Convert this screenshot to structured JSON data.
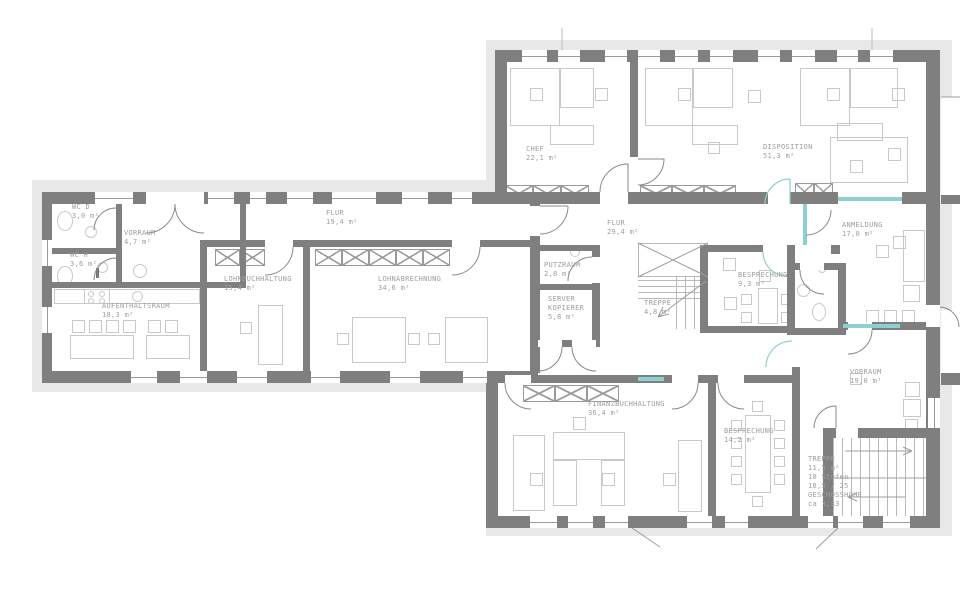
{
  "rooms": {
    "chef": {
      "name": "CHEF",
      "area": "22,1 m²"
    },
    "disposition": {
      "name": "DISPOSITION",
      "area": "51,3 m²"
    },
    "flur_rechts": {
      "name": "FLUR",
      "area": "29,4 m²"
    },
    "anmeldung": {
      "name": "ANMELDUNG",
      "area": "17,0 m²"
    },
    "wc_d": {
      "name": "WC D",
      "area": "3,0 m²"
    },
    "wc_h": {
      "name": "WC H",
      "area": "3,6 m²"
    },
    "vorraum_klein": {
      "name": "VORRAUM",
      "area": "4,7 m²"
    },
    "flur_links": {
      "name": "FLUR",
      "area": "19,4 m²"
    },
    "aufenthaltsraum": {
      "name": "AUFENTHALTSRAUM",
      "area": "18,3 m²"
    },
    "lohnbuchhaltung": {
      "name": "LOHNBUCHHALTUNG",
      "area": "15,4 m²"
    },
    "lohnabrechnung": {
      "name": "LOHNABRECHNUNG",
      "area": "34,6 m²"
    },
    "putzraum": {
      "name": "PUTZRAUM",
      "area": "2,8 m²"
    },
    "server": {
      "name": "SERVER",
      "name2": "KOPIERER",
      "area": "5,8 m²"
    },
    "treppe_mitte": {
      "name": "TREPPE",
      "area": "4,8 m²"
    },
    "besprechung_klein": {
      "name": "BESPRECHUNG",
      "area": "9,3 m²"
    },
    "vorraum_gross": {
      "name": "VORRAUM",
      "area": "19,0 m²"
    },
    "besprechung_gross": {
      "name": "BESPRECHUNG",
      "area": "14,2 m²"
    },
    "finanzbuchhaltung": {
      "name": "FINANZBUCHHALTUNG",
      "area": "36,4 m²"
    },
    "treppe_haupt": {
      "name": "TREPPE",
      "area": "11,5 m²",
      "stufen": "18 Stufen",
      "steigung": "18,5 / 25",
      "geschoss": "GESCHOSSHÖHE",
      "hoehe": "ca 3,33"
    }
  },
  "colors": {
    "wall": "#7f7f7f",
    "band": "#e8e8e8",
    "glass": "#8ed0cd",
    "furniture": "#c9c9c9",
    "label": "#9aa0a0"
  }
}
